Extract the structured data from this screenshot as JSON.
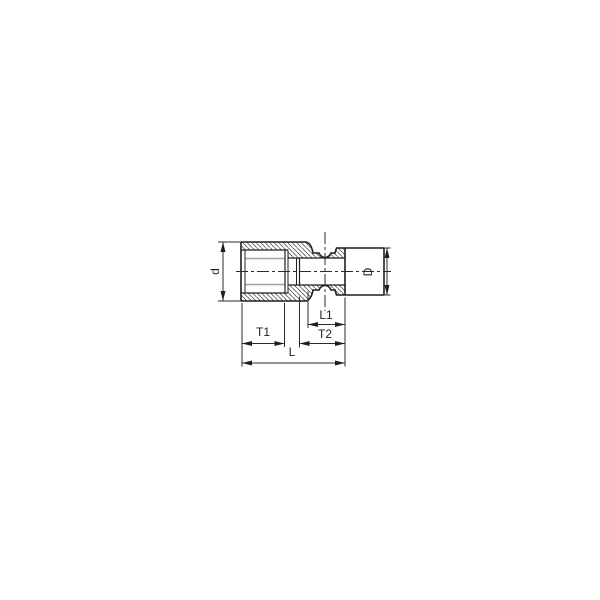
{
  "page": {
    "background": "#ffffff"
  },
  "drawing": {
    "kind": "socket cross-section technical drawing",
    "colors": {
      "outline": "#1f1f1f",
      "soft_line": "#a3a3a3",
      "dimension_line": "#2b2b2b",
      "background": "#ffffff"
    },
    "labels": {
      "d": "d",
      "D": "D",
      "t1": "T1",
      "l1": "L1",
      "t2": "T2",
      "l": "L"
    }
  }
}
